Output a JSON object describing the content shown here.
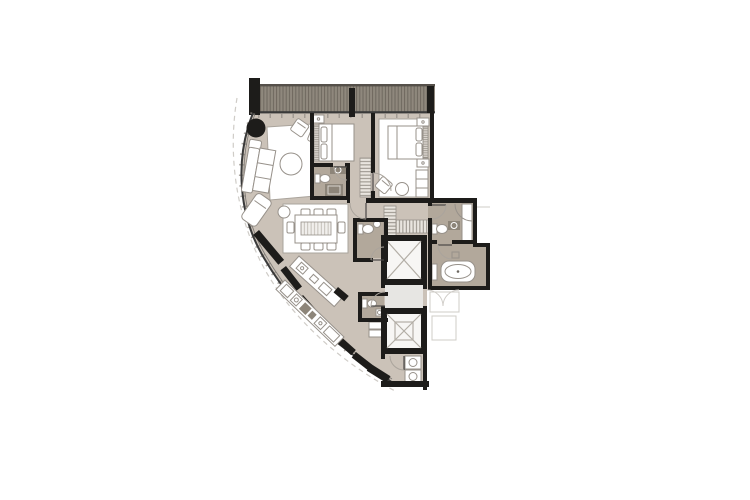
{
  "figure": {
    "type": "architectural-floor-plan",
    "description": "fan-shaped apartment unit plan with curved glazed facade, two bedrooms, central elevator core",
    "visible_text": []
  },
  "palette": {
    "background": "#ffffff",
    "floor": "#cbc2b8",
    "floorDark": "#b2a89b",
    "balcony": "#8f887d",
    "balconyStripe": "#6e675e",
    "balconyEdge": "#55504a",
    "wall": "#1d1c1a",
    "glass": "#3a3a3a",
    "lobby": "#e7e6e3",
    "furnitureStroke": "#97918a",
    "lightLine": "#aaa49c",
    "hatch": "#8a847c",
    "fixtureDark": "#8d8579",
    "faint": "#cfccc7"
  },
  "rooms": [
    {
      "name": "balcony-strip"
    },
    {
      "name": "living-room"
    },
    {
      "name": "dining-area"
    },
    {
      "name": "kitchen"
    },
    {
      "name": "bedroom-2"
    },
    {
      "name": "bathroom-2"
    },
    {
      "name": "master-bedroom"
    },
    {
      "name": "master-bathroom"
    },
    {
      "name": "bathtub-room"
    },
    {
      "name": "guest-wc"
    },
    {
      "name": "service-wc"
    },
    {
      "name": "hallway"
    },
    {
      "name": "walk-in-closet"
    },
    {
      "name": "elevator-lobby"
    },
    {
      "name": "elevator-shaft-upper"
    },
    {
      "name": "elevator-shaft-lower"
    },
    {
      "name": "utility-room"
    }
  ],
  "furniture": [
    {
      "name": "l-shaped-sofa"
    },
    {
      "name": "coffee-table"
    },
    {
      "name": "armchairs"
    },
    {
      "name": "round-column"
    },
    {
      "name": "dining-table-8"
    },
    {
      "name": "kitchen-island"
    },
    {
      "name": "curved-kitchen-counter"
    },
    {
      "name": "double-bed"
    },
    {
      "name": "wardrobe"
    },
    {
      "name": "bathtub"
    },
    {
      "name": "shower"
    },
    {
      "name": "toilet"
    },
    {
      "name": "sink"
    },
    {
      "name": "washer-dryer-stack"
    },
    {
      "name": "bench-seat"
    }
  ]
}
